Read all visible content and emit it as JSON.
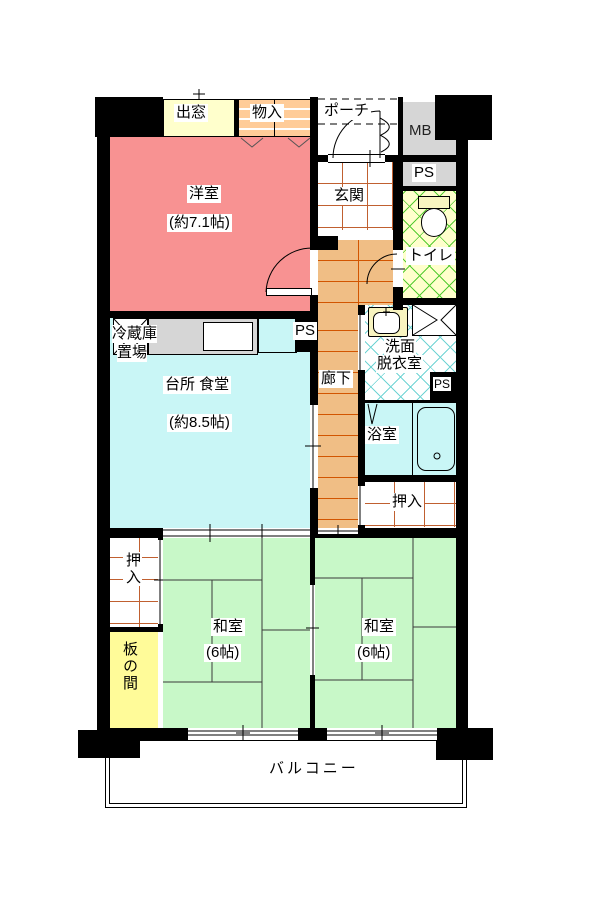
{
  "rooms": {
    "bay_window": {
      "label": "出窓"
    },
    "storage": {
      "label": "物入"
    },
    "porch": {
      "label": "ポーチ"
    },
    "meter_box": {
      "label": "MB"
    },
    "pipe_space": {
      "label": "PS"
    },
    "entrance": {
      "label": "玄関"
    },
    "toilet": {
      "label": "トイレ"
    },
    "western_room": {
      "label": "洋室",
      "size": "(約7.1帖)"
    },
    "fridge_space": {
      "line1": "冷蔵庫",
      "line2": "置場"
    },
    "kitchen": {
      "label": "台所 食堂",
      "size": "(約8.5帖)"
    },
    "corridor": {
      "label": "廊下"
    },
    "washroom": {
      "line1": "洗面",
      "line2": "脱衣室"
    },
    "bathroom": {
      "label": "浴室"
    },
    "closet_upper": {
      "label": "押入"
    },
    "japanese_left": {
      "label": "和室",
      "size": "(6帖)"
    },
    "japanese_right": {
      "label": "和室",
      "size": "(6帖)"
    },
    "closet_left": {
      "label": "押入"
    },
    "itanoma": {
      "label": "板の間"
    },
    "balcony": {
      "label": "バルコニー"
    }
  },
  "colors": {
    "wall": "#000000",
    "western_room": "#F89292",
    "kitchen": "#C9F6F6",
    "japanese_room": "#C8F8C8",
    "itanoma": "#FFFB99",
    "bay_window": "#FFFFCC",
    "storage": "#FFCC99",
    "toilet_bg": "#FFFFCC",
    "toilet_grid": "#55CC33",
    "washroom_grid": "#70D4D4",
    "corridor_bg": "#F0BE85",
    "corridor_line": "#D25500",
    "tile_line": "#C06030",
    "closet_line": "#C06030",
    "service_gray": "#D6D6D6",
    "fixture_cream": "#F8F4C0"
  }
}
